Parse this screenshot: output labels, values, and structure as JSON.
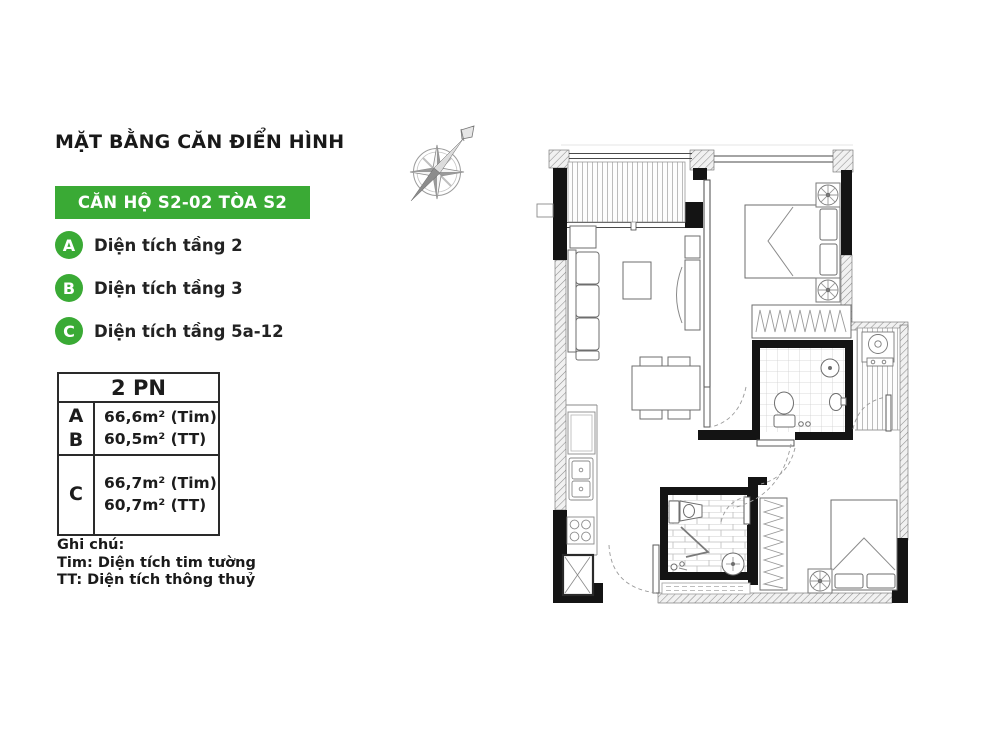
{
  "colors": {
    "accent_green": "#3aaa35",
    "wall_black": "#141414"
  },
  "header": {
    "title": "MẶT BẰNG CĂN ĐIỂN HÌNH"
  },
  "badge": {
    "label": "CĂN HỘ S2-02 TÒA S2"
  },
  "legend": {
    "items": [
      {
        "key": "A",
        "label": "Diện tích tầng 2"
      },
      {
        "key": "B",
        "label": "Diện tích tầng 3"
      },
      {
        "key": "C",
        "label": "Diện tích tầng 5a-12"
      }
    ]
  },
  "area_table": {
    "header": "2 PN",
    "rows": [
      {
        "keys": [
          "A",
          "B"
        ],
        "lines": [
          "66,6m² (Tim)",
          "60,5m² (TT)"
        ]
      },
      {
        "keys": [
          "C"
        ],
        "lines": [
          "66,7m² (Tim)",
          "60,7m² (TT)"
        ]
      }
    ]
  },
  "notes": {
    "title": "Ghi chú:",
    "lines": [
      "Tim: Diện tích tim tường",
      "TT: Diện tích thông thuỷ"
    ]
  },
  "icons": {
    "compass": "compass-rose-icon"
  }
}
